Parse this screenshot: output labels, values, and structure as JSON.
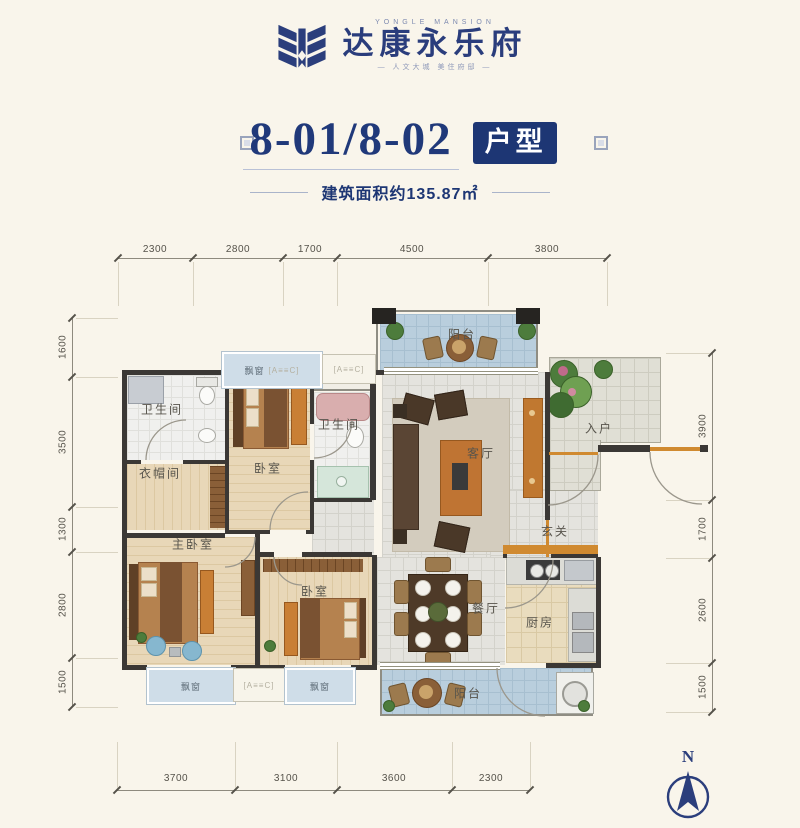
{
  "header": {
    "brand_en": "YONGLE MANSION",
    "brand_cn": "达康永乐府",
    "tagline": "— 人文大城 美住府邸 —",
    "title": "8-01/8-02",
    "badge": "户型",
    "area_note": "建筑面积约135.87㎡"
  },
  "plan": {
    "rooms": {
      "balcony_top": "阳台",
      "bath_top": "卫生间",
      "bedroom_top": "卧室",
      "bath_mid": "卫生间",
      "cloakroom": "衣帽间",
      "master_bedroom": "主卧室",
      "bedroom_bottom": "卧室",
      "living": "客厅",
      "entry": "入户",
      "foyer": "玄关",
      "dining": "餐厅",
      "kitchen": "厨房",
      "balcony_bottom": "阳台",
      "bay_window": "飘窗",
      "ac_annotation": "[A≡≡C]"
    },
    "dims": {
      "top": [
        "2300",
        "2800",
        "1700",
        "4500",
        "3800"
      ],
      "left": [
        "1600",
        "3500",
        "1300",
        "2800",
        "1500"
      ],
      "right": [
        "3900",
        "1700",
        "2600",
        "1500"
      ],
      "bottom": [
        "3700",
        "3100",
        "3600",
        "2300"
      ]
    },
    "north_label": "N"
  },
  "colors": {
    "navy": "#1d3674",
    "wall": "#3b3835",
    "accent_orange": "#d08a30",
    "balcony_tile": "#b9cedd",
    "wood_floor": "#e8d7b8",
    "background": "#f9f5eb"
  }
}
